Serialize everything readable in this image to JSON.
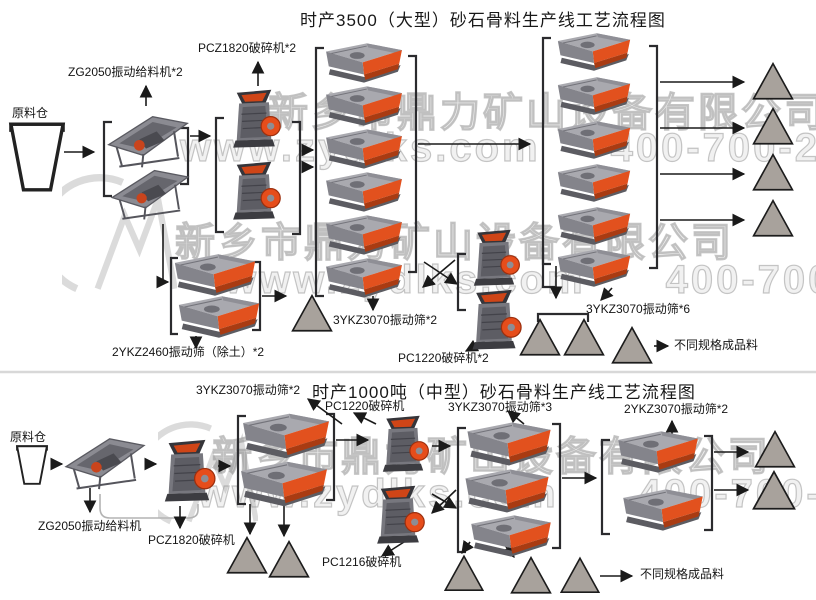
{
  "watermark": {
    "company": "新乡市鼎力矿山设备有限公司",
    "website": "www.zydlks.com",
    "phone": "400-700-2111"
  },
  "colors": {
    "machine_orange": "#e2511e",
    "machine_gray": "#8a8a90",
    "pile_gray": "#a8a29c",
    "flow_line": "#1a1a1a",
    "watermark_gray": "#8c8c8c"
  },
  "top_diagram": {
    "title": "时产3500（大型）砂石骨料生产线工艺流程图",
    "labels": {
      "raw_bin": "原料仓",
      "feeder": "ZG2050振动给料机*2",
      "primary_crusher": "PCZ1820破碎机*2",
      "soil_screen": "2YKZ2460振动筛（除土）*2",
      "mid_screen": "3YKZ3070振动筛*2",
      "secondary_crusher": "PC1220破碎机*2",
      "product_screen": "3YKZ3070振动筛*6",
      "product": "不同规格成品料"
    }
  },
  "bottom_diagram": {
    "title": "时产1000吨（中型）砂石骨料生产线工艺流程图",
    "labels": {
      "raw_bin": "原料仓",
      "feeder": "ZG2050振动给料机",
      "primary_crusher": "PCZ1820破碎机",
      "screen_2deck": "3YKZ3070振动筛*2",
      "secondary_crusher": "PC1220破碎机",
      "screen_3deck": "3YKZ3070振动筛*3",
      "tertiary_crusher": "PC1216破碎机",
      "final_screen": "2YKZ3070振动筛*2",
      "product": "不同规格成品料"
    }
  }
}
